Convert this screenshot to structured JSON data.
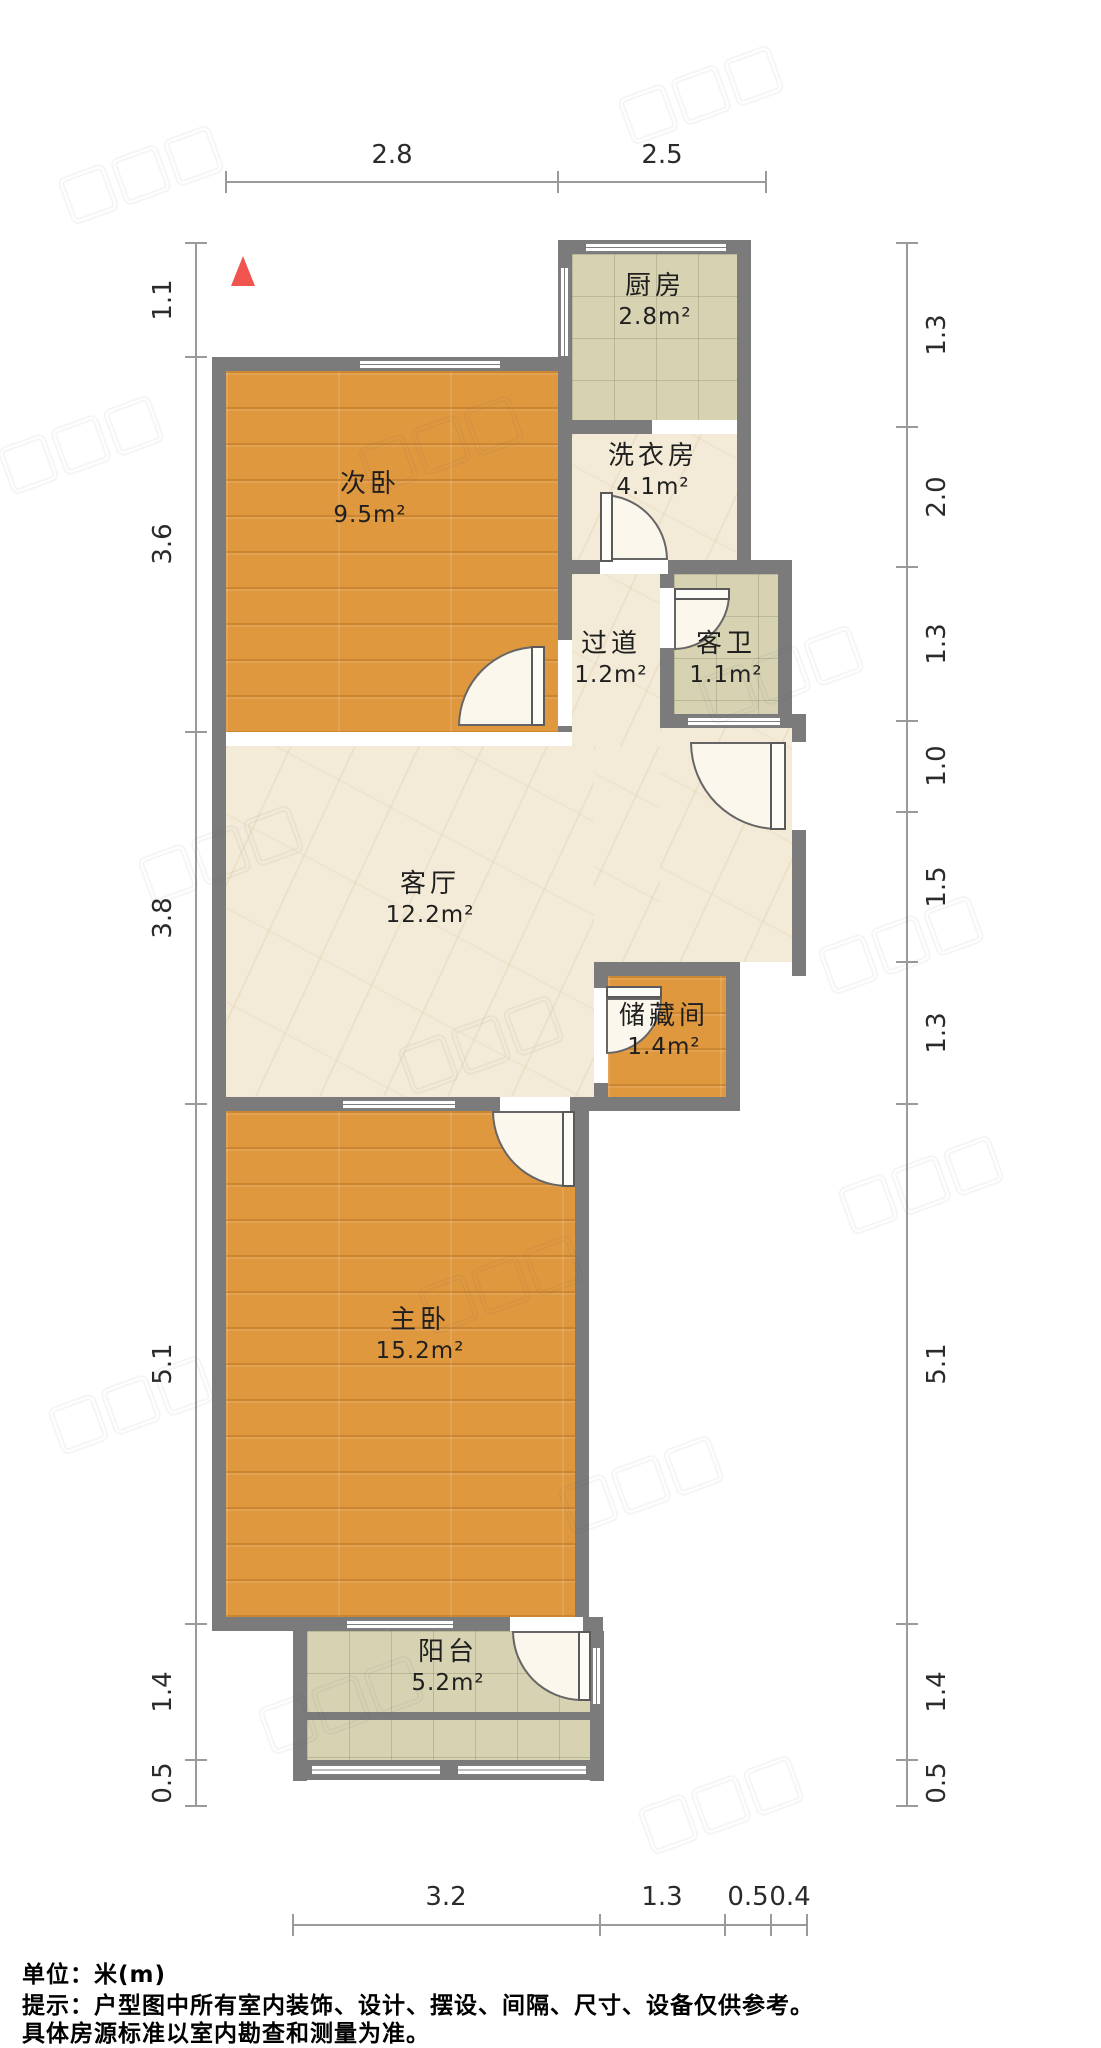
{
  "plan": {
    "north_marker": "red-triangle-north",
    "unit": "meters"
  },
  "rooms": {
    "kitchen": {
      "name": "厨房",
      "area": "2.8m²"
    },
    "laundry": {
      "name": "洗衣房",
      "area": "4.1m²"
    },
    "bedroom2": {
      "name": "次卧",
      "area": "9.5m²"
    },
    "hallway": {
      "name": "过道",
      "area": "1.2m²"
    },
    "bathroom": {
      "name": "客卫",
      "area": "1.1m²"
    },
    "living": {
      "name": "客厅",
      "area": "12.2m²"
    },
    "storage": {
      "name": "储藏间",
      "area": "1.4m²"
    },
    "master": {
      "name": "主卧",
      "area": "15.2m²"
    },
    "balcony": {
      "name": "阳台",
      "area": "5.2m²"
    }
  },
  "dims": {
    "top": [
      "2.8",
      "2.5"
    ],
    "left": [
      "1.1",
      "3.6",
      "3.8",
      "5.1",
      "1.4",
      "0.5"
    ],
    "right": [
      "1.3",
      "2.0",
      "1.3",
      "1.0",
      "1.5",
      "1.3",
      "5.1",
      "1.4",
      "0.5"
    ],
    "bottom": [
      "3.2",
      "1.3",
      "0.5",
      "0.4"
    ]
  },
  "footer": {
    "unit_line": "单位：米(m)",
    "note_line1": "提示：户型图中所有室内装饰、设计、摆设、间隔、尺寸、设备仅供参考。",
    "note_line2": "具体房源标准以室内勘查和测量为准。"
  },
  "colors": {
    "wall": "#7b7b7b",
    "wood_floor": "#e0983f",
    "tile_floor": "#d6d2b2",
    "marble_floor": "#f3ead7",
    "north_marker": "#f0544f",
    "dimension_line": "#9a9a9a"
  }
}
